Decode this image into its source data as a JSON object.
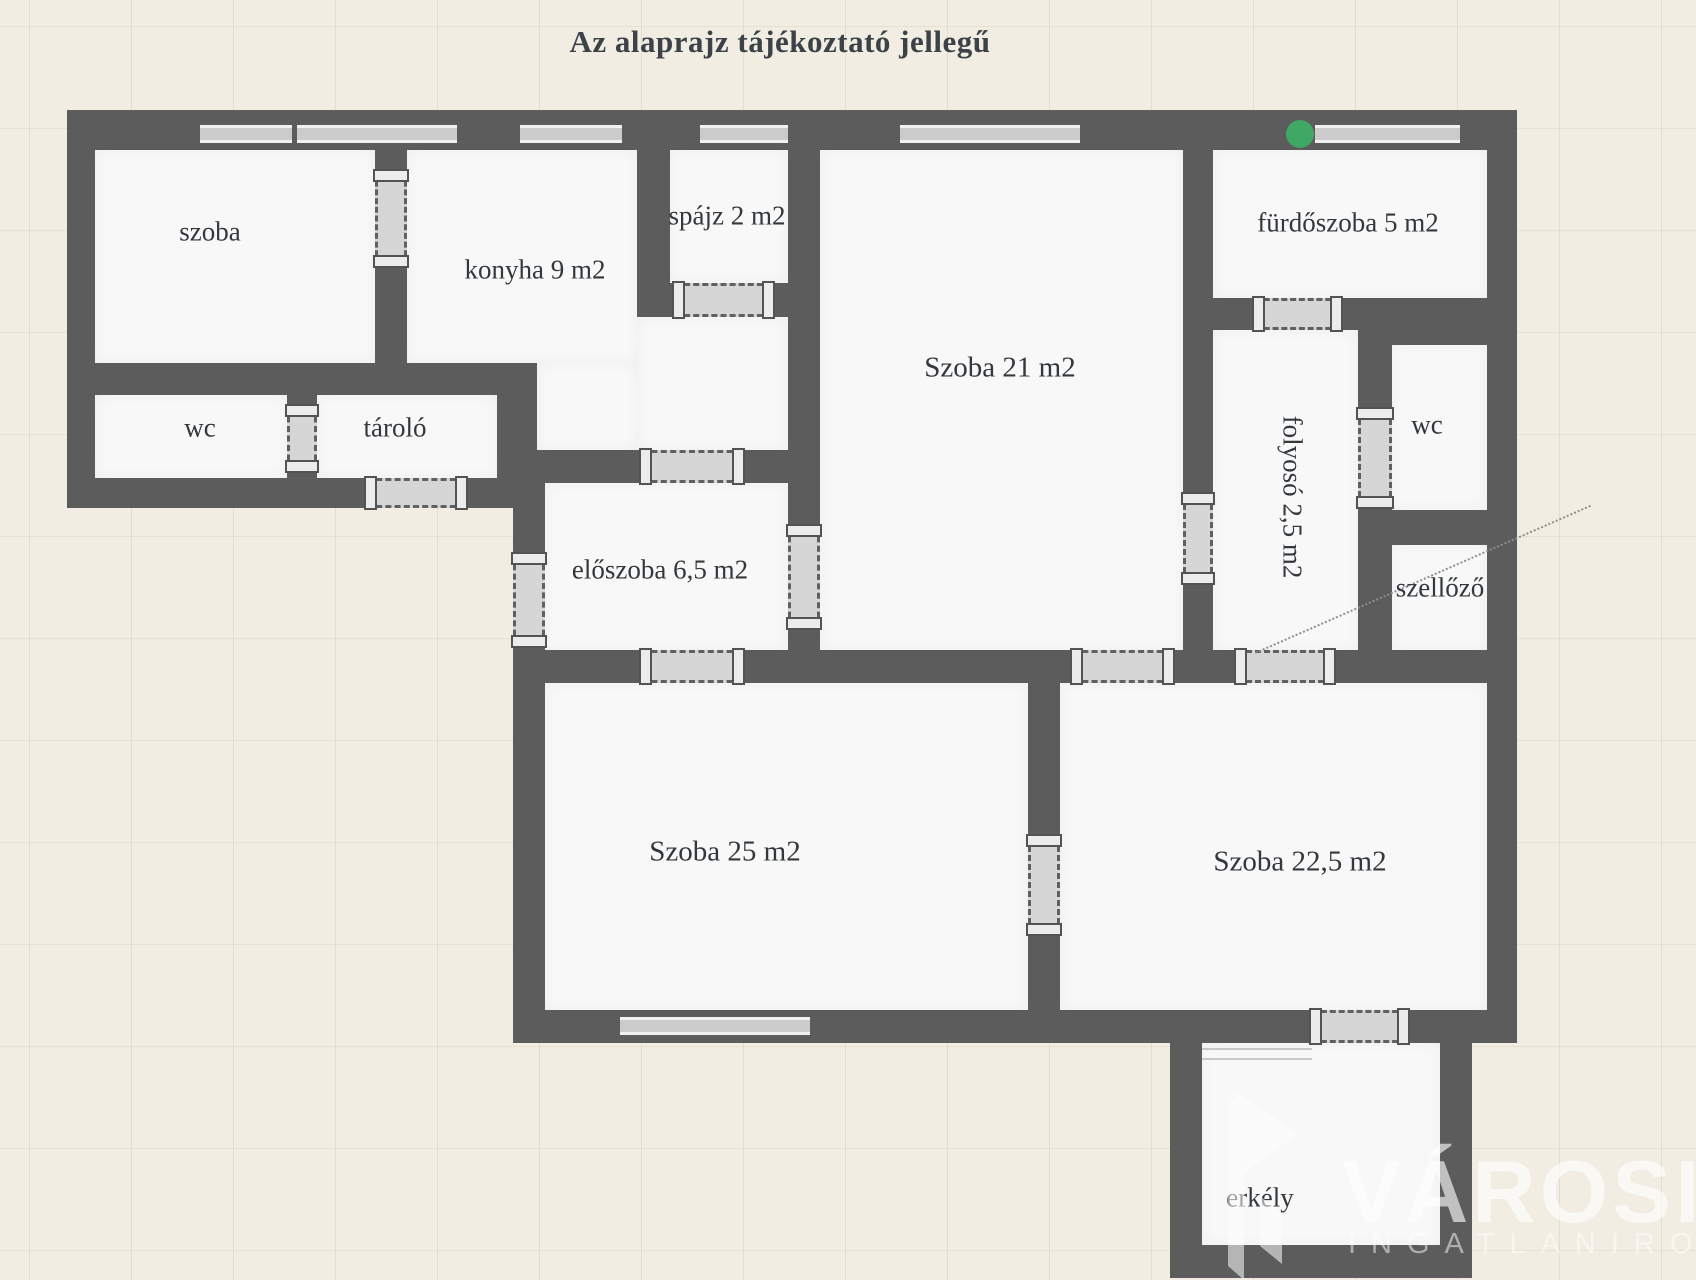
{
  "title": "Az alaprajz tájékoztató jellegű",
  "rooms": {
    "szoba_tl": {
      "label": "szoba"
    },
    "konyha": {
      "label": "konyha 9 m2"
    },
    "spajz": {
      "label": "spájz 2 m2"
    },
    "szoba21": {
      "label": "Szoba 21 m2"
    },
    "furdoszoba": {
      "label": "fürdőszoba 5 m2"
    },
    "wc_left": {
      "label": "wc"
    },
    "tarolo": {
      "label": "tároló"
    },
    "eloszoba": {
      "label": "előszoba 6,5 m2"
    },
    "folyoso": {
      "label": "folyosó 2,5 m2"
    },
    "wc_right": {
      "label": "wc"
    },
    "szellozo": {
      "label": "szellőző"
    },
    "szoba25": {
      "label": "Szoba 25 m2"
    },
    "szoba225": {
      "label": "Szoba 22,5 m2"
    },
    "erkely": {
      "label": "erkély"
    }
  },
  "watermark": {
    "brand": "VÁROSI",
    "subtitle": "INGATLANIRODA"
  },
  "colors": {
    "background": "#f2ede2",
    "wall": "#5c5c5c",
    "room_floor": "#f8f8f8",
    "door": "#d6d6d6",
    "window": "#cbcbcb",
    "entrance_marker": "#3fa864",
    "watermark_text": "#ffffff"
  }
}
